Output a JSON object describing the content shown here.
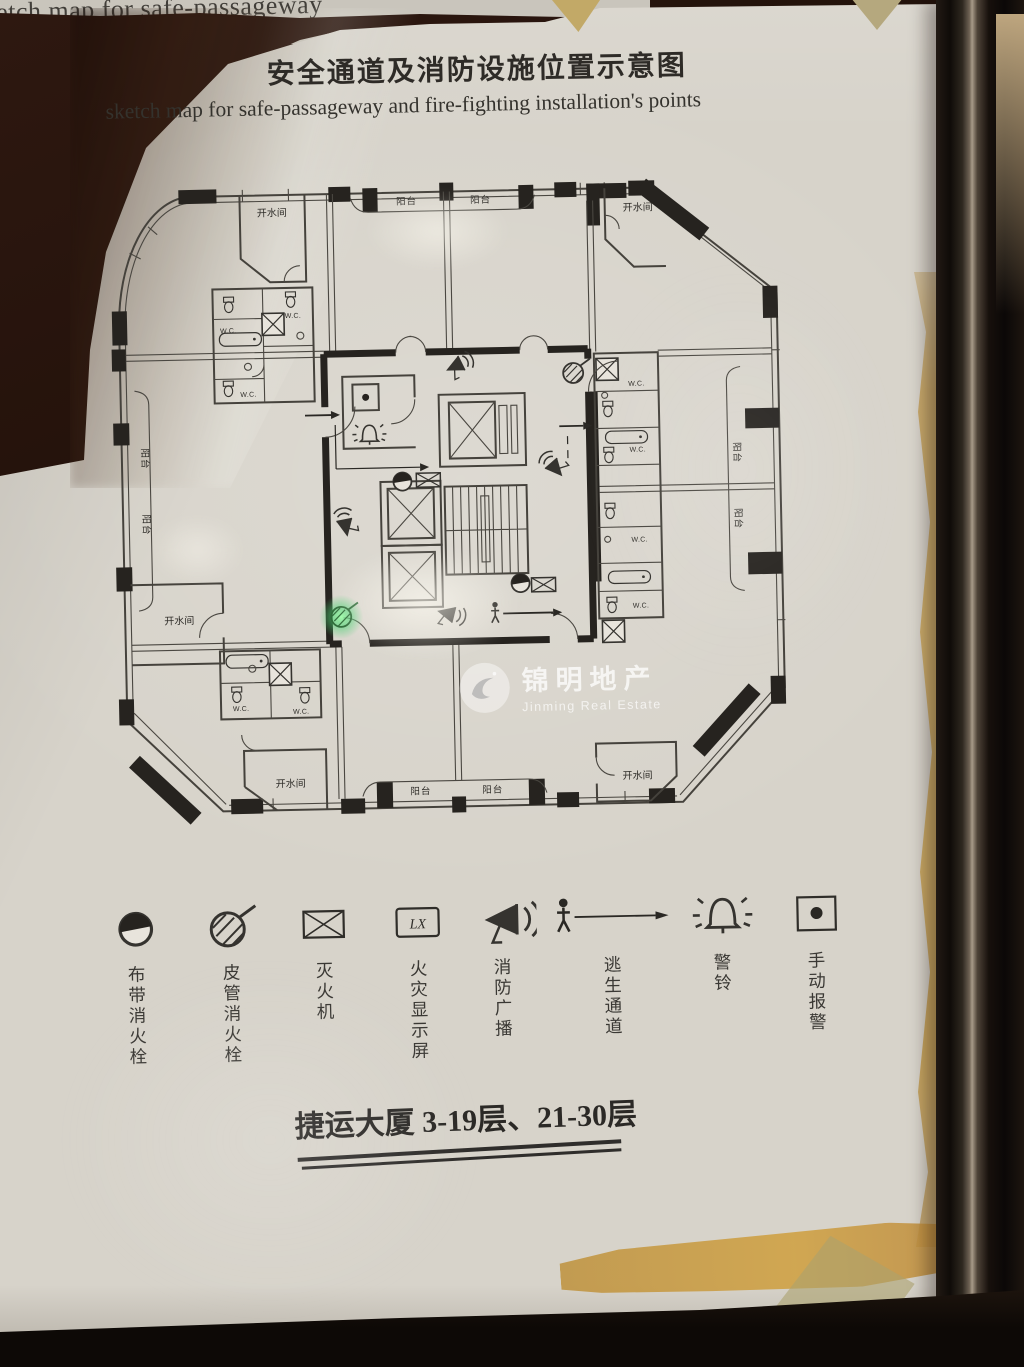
{
  "backdrop": {
    "behind_page_text": "sketch map for safe-passageway"
  },
  "header": {
    "title_cn": "安全通道及消防设施位置示意图",
    "title_en": "sketch map for safe-passageway and fire-fighting installation's points"
  },
  "plan": {
    "labels": {
      "hot_water": "开水间",
      "balcony": "阳台",
      "wc": "W.C."
    }
  },
  "legend": {
    "items": [
      {
        "icon": "band-hydrant-icon",
        "label": "布带消火栓"
      },
      {
        "icon": "hose-hydrant-icon",
        "label": "皮管消火栓"
      },
      {
        "icon": "extinguisher-icon",
        "label": "灭火机"
      },
      {
        "icon": "fire-display-icon",
        "label": "火灾显示屏",
        "screen_text": "LX"
      },
      {
        "icon": "fire-broadcast-icon",
        "label": "消防广播"
      },
      {
        "icon": "escape-route-icon",
        "label": "逃生通道"
      },
      {
        "icon": "alarm-bell-icon",
        "label": "警铃"
      },
      {
        "icon": "manual-alarm-icon",
        "label": "手动报警"
      }
    ]
  },
  "footer": {
    "building_caption": "捷运大厦 3-19层、21-30层"
  },
  "watermark": {
    "text_cn": "锦明地产",
    "text_en": "Jinming Real Estate"
  }
}
